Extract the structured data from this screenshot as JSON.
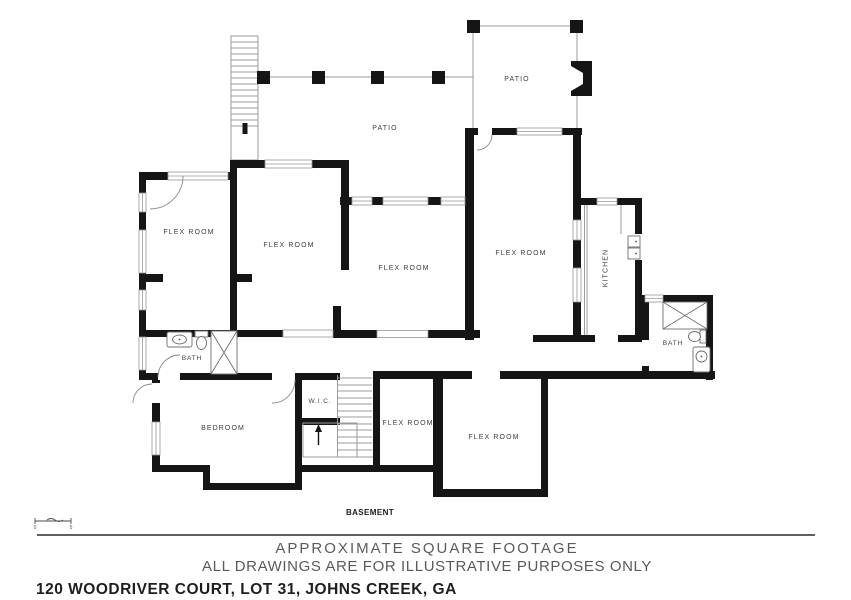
{
  "rooms": {
    "patio_upper": "PATIO",
    "patio_main": "PATIO",
    "flex_room_topleft": "FLEX ROOM",
    "flex_room_left": "FLEX ROOM",
    "flex_room_center": "FLEX ROOM",
    "flex_room_topright": "FLEX ROOM",
    "flex_room_small": "FLEX ROOM",
    "flex_room_bottomright": "FLEX ROOM",
    "kitchen": "KITCHEN",
    "bath_left": "BATH",
    "bath_right": "BATH",
    "bedroom": "BEDROOM",
    "wic": "W.I.C."
  },
  "floor_label": "BASEMENT",
  "scale_bar": {
    "start": "0",
    "end": "5"
  },
  "footer": {
    "approx": "APPROXIMATE SQUARE FOOTAGE",
    "disclaimer": "ALL DRAWINGS ARE FOR ILLUSTRATIVE PURPOSES ONLY",
    "address": "120 WOODRIVER COURT, LOT 31, JOHNS CREEK, GA"
  },
  "colors": {
    "wall": "#151515",
    "thin_line": "#9b9b9b",
    "room_label": "#3d3d3d",
    "footer_text": "#595a5c",
    "address_text": "#1e1e1e",
    "background": "#ffffff"
  }
}
